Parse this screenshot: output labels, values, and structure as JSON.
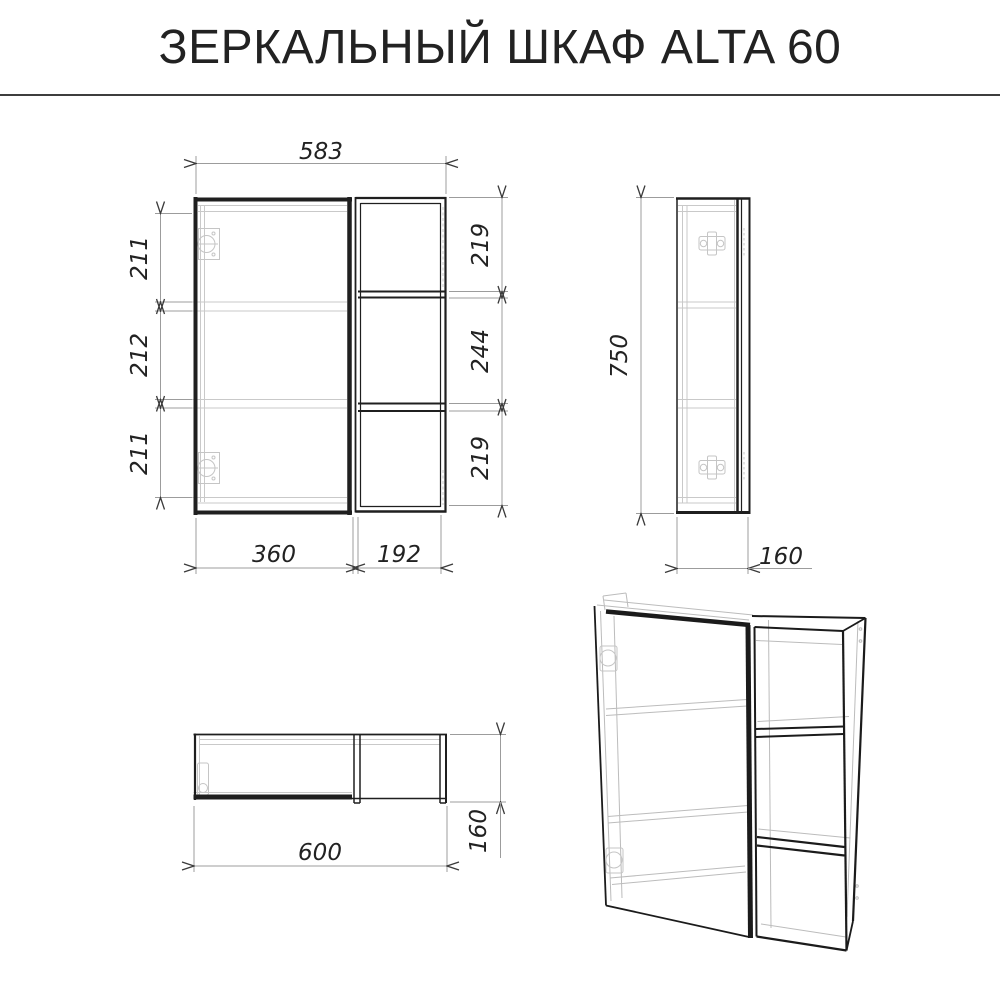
{
  "title": "ЗЕРКАЛЬНЫЙ ШКАФ ALTA 60",
  "front_view": {
    "dim_width_top": "583",
    "dim_left_top": "211",
    "dim_left_mid": "212",
    "dim_left_bot": "211",
    "dim_right_top": "219",
    "dim_right_mid": "244",
    "dim_right_bot": "219",
    "dim_bottom_door": "360",
    "dim_bottom_shelf": "192"
  },
  "side_view": {
    "dim_height": "750",
    "dim_depth": "160"
  },
  "bottom_view": {
    "dim_width": "600",
    "dim_depth": "160"
  },
  "colors": {
    "line_dark": "#1f1f1f",
    "line_light": "#c9c9c9",
    "dim_line": "#9c9c9c",
    "arrow": "#3a3a3a",
    "text": "#222222"
  }
}
